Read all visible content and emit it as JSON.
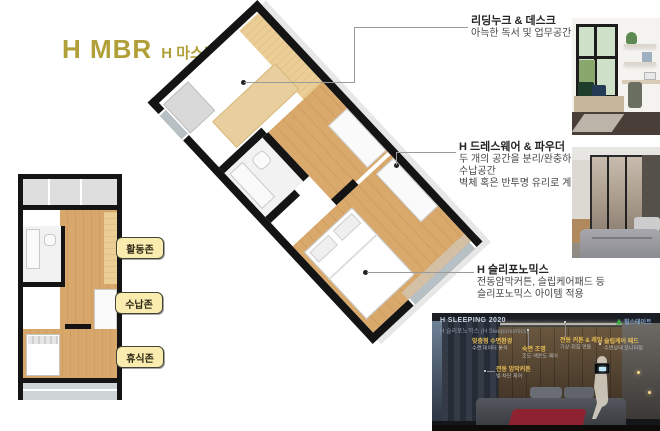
{
  "header": {
    "title": "H MBR",
    "subtitle": "H 마스터룸"
  },
  "zones": {
    "items": [
      {
        "label": "활동존"
      },
      {
        "label": "수납존"
      },
      {
        "label": "휴식존"
      }
    ]
  },
  "annotations": {
    "items": [
      {
        "heading": "리딩누크 & 데스크",
        "line1": "아늑한 독서 및 업무공간"
      },
      {
        "heading": "H 드레스웨어 & 파우더",
        "line1": "두 개의 공간을 분리/완충하는",
        "line2": "수납공간",
        "line3": "벽체 혹은 반투명 유리로 계획"
      },
      {
        "heading": "H 슬리포노믹스",
        "line1": "전동암막커튼, 슬립케어패드 등",
        "line2": "슬리포노믹스 아이템 적용"
      }
    ]
  },
  "dark_panel": {
    "title": "H SLEEPING 2020",
    "subtitle": "H 슬리포노믹스 (H Sleeponomics)",
    "logo_text": "힐스테이트",
    "callouts": [
      {
        "heading": "맞춤형 수면환경",
        "sub": "수면 데이터 분석"
      },
      {
        "heading": "전동 암막커튼",
        "sub": "빛 차단 제어"
      },
      {
        "heading": "숙면 조명",
        "sub": "조도·색온도 제어"
      },
      {
        "heading": "전동 커튼 & 레일",
        "sub": "기상·취침 연동"
      },
      {
        "heading": "슬립케어 패드",
        "sub": "수면상태 모니터링"
      }
    ]
  },
  "colors": {
    "accent_gold": "#b1a03a",
    "zone_label_bg": "#faecae",
    "wall_black": "#141414",
    "wood": "#d8a76c",
    "desk_tan": "#eace96"
  }
}
